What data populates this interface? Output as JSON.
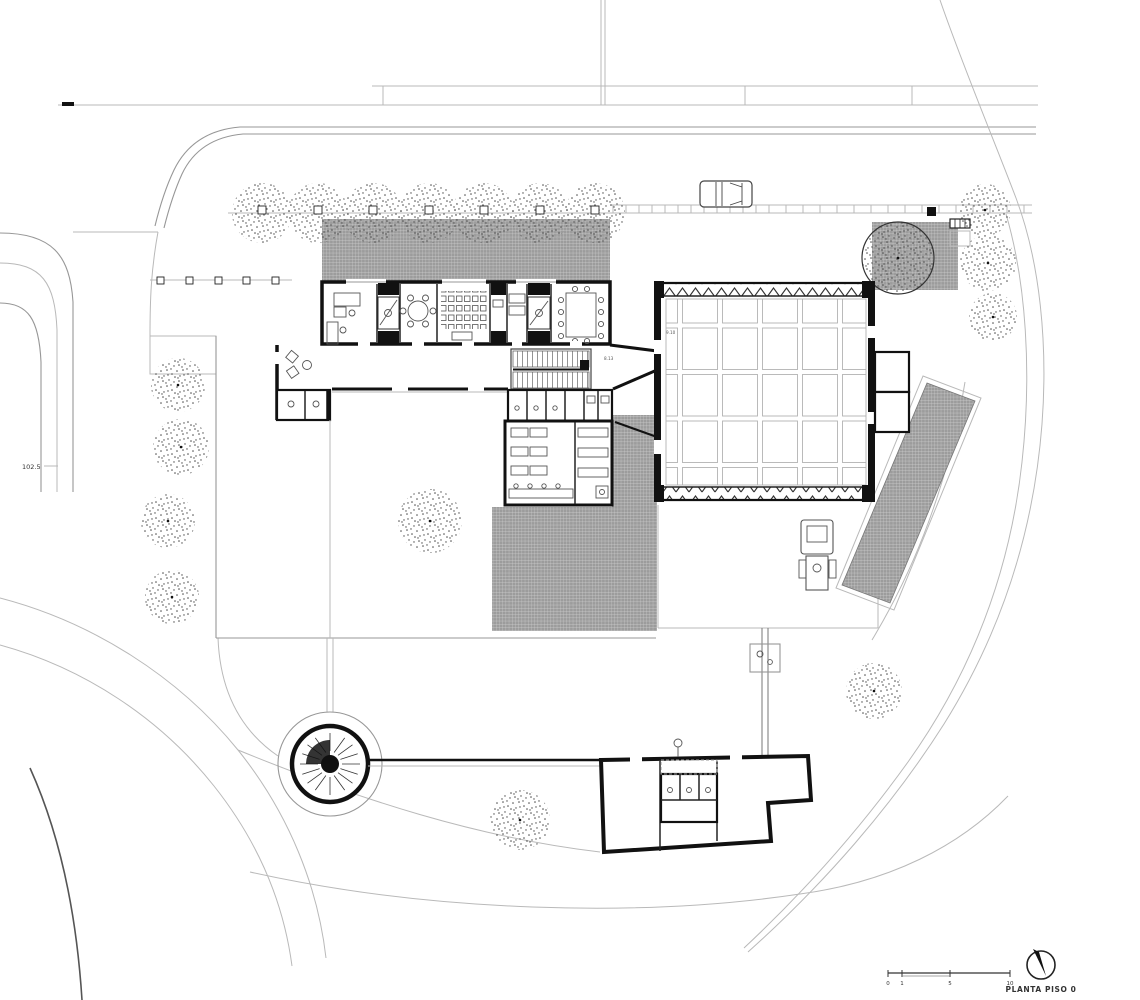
{
  "drawing": {
    "title": "PLANTA PISO 0",
    "level_label": "102.5",
    "dims": {
      "hall": "9.10",
      "vestibule": "8.13"
    },
    "scale": {
      "t0": "0",
      "t1": "1",
      "t5": "5",
      "t10": "10"
    },
    "colors": {
      "paper": "#ffffff",
      "wall": "#111111",
      "line": "#555555",
      "light_line": "#b9b9b9",
      "paving_hatch": "#9c9c9c"
    }
  }
}
